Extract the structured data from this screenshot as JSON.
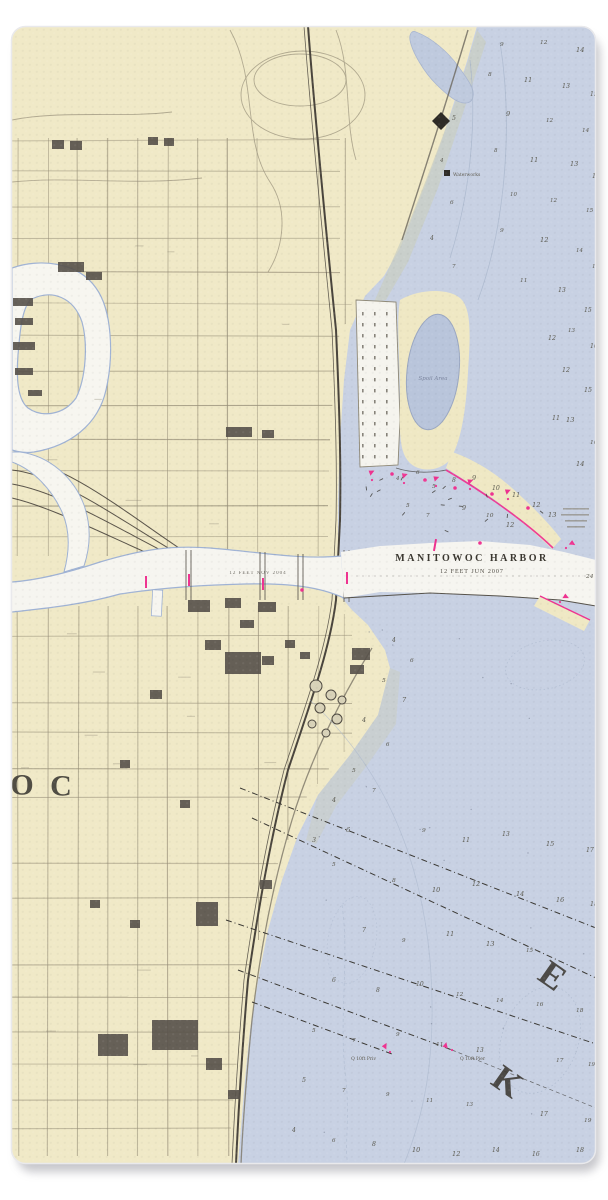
{
  "page": {
    "background": "#ffffff"
  },
  "towel": {
    "shadow_color": "rgba(130,130,138,0.5)",
    "base_land_color": "#f0e9c7",
    "water_color": "#c8d1e3"
  },
  "chart": {
    "title": "MANITOWOC HARBOR",
    "subtitle": "12 FEET JUN 2007",
    "channel_note": "12 FEET NOV 2004",
    "spoil_area_label": "Spoil Area",
    "waterworks_label": "Waterworks",
    "pier_label_left": "Q 10ft Priv",
    "pier_label_right": "Q 10ft Pier",
    "colors": {
      "land": "#f0e9c7",
      "water": "#c8d1e3",
      "pond": "#b9c5db",
      "channel_white": "#f6f5f0",
      "shoal": "#cacec3",
      "magenta": "#ee3390",
      "ink": "#3c3933",
      "rail": "#4a453d",
      "grid": "#948c76",
      "contour": "#a9b6cc"
    },
    "large_letters": [
      {
        "char": "O",
        "x": 22,
        "y": 784,
        "size": 30,
        "rot": 0
      },
      {
        "char": "C",
        "x": 61,
        "y": 785,
        "size": 30,
        "rot": 0
      },
      {
        "char": "E",
        "x": 553,
        "y": 975,
        "size": 36,
        "rot": 35
      },
      {
        "char": "K",
        "x": 508,
        "y": 1081,
        "size": 36,
        "rot": 35
      }
    ],
    "depth_soundings": [
      [
        500,
        46,
        "9"
      ],
      [
        540,
        44,
        "12"
      ],
      [
        576,
        52,
        "14"
      ],
      [
        488,
        76,
        "8"
      ],
      [
        524,
        82,
        "11"
      ],
      [
        562,
        88,
        "13"
      ],
      [
        590,
        96,
        "15"
      ],
      [
        506,
        116,
        "9"
      ],
      [
        546,
        122,
        "12"
      ],
      [
        582,
        132,
        "14"
      ],
      [
        494,
        152,
        "8"
      ],
      [
        530,
        162,
        "11"
      ],
      [
        570,
        166,
        "13"
      ],
      [
        592,
        178,
        "16"
      ],
      [
        510,
        196,
        "10"
      ],
      [
        550,
        202,
        "12"
      ],
      [
        586,
        212,
        "15"
      ],
      [
        500,
        232,
        "9"
      ],
      [
        540,
        242,
        "12"
      ],
      [
        576,
        252,
        "14"
      ],
      [
        592,
        268,
        "16"
      ],
      [
        520,
        282,
        "11"
      ],
      [
        558,
        292,
        "13"
      ],
      [
        452,
        120,
        "5"
      ],
      [
        440,
        162,
        "4"
      ],
      [
        450,
        204,
        "6"
      ],
      [
        430,
        240,
        "4"
      ],
      [
        452,
        268,
        "7"
      ],
      [
        584,
        312,
        "15"
      ],
      [
        568,
        332,
        "13"
      ],
      [
        590,
        348,
        "16"
      ],
      [
        562,
        372,
        "12"
      ],
      [
        584,
        392,
        "15"
      ],
      [
        566,
        422,
        "13"
      ],
      [
        590,
        444,
        "16"
      ],
      [
        576,
        466,
        "14"
      ],
      [
        548,
        340,
        "12"
      ],
      [
        552,
        420,
        "11"
      ],
      [
        396,
        480,
        "4"
      ],
      [
        416,
        474,
        "6"
      ],
      [
        432,
        488,
        "5"
      ],
      [
        452,
        482,
        "8"
      ],
      [
        472,
        480,
        "9"
      ],
      [
        492,
        490,
        "10"
      ],
      [
        512,
        497,
        "11"
      ],
      [
        532,
        507,
        "12"
      ],
      [
        548,
        517,
        "13"
      ],
      [
        406,
        507,
        "5"
      ],
      [
        426,
        517,
        "7"
      ],
      [
        462,
        510,
        "9"
      ],
      [
        486,
        517,
        "10"
      ],
      [
        506,
        527,
        "12"
      ],
      [
        586,
        578,
        "24"
      ],
      [
        392,
        642,
        "4"
      ],
      [
        410,
        662,
        "6"
      ],
      [
        382,
        682,
        "5"
      ],
      [
        402,
        702,
        "7"
      ],
      [
        362,
        722,
        "4"
      ],
      [
        386,
        746,
        "6"
      ],
      [
        352,
        772,
        "5"
      ],
      [
        372,
        792,
        "7"
      ],
      [
        332,
        802,
        "4"
      ],
      [
        346,
        832,
        "6"
      ],
      [
        312,
        842,
        "3"
      ],
      [
        332,
        866,
        "5"
      ],
      [
        422,
        832,
        "9"
      ],
      [
        462,
        842,
        "11"
      ],
      [
        502,
        836,
        "13"
      ],
      [
        546,
        846,
        "15"
      ],
      [
        586,
        852,
        "17"
      ],
      [
        392,
        882,
        "8"
      ],
      [
        432,
        892,
        "10"
      ],
      [
        472,
        886,
        "12"
      ],
      [
        516,
        896,
        "14"
      ],
      [
        556,
        902,
        "16"
      ],
      [
        590,
        906,
        "18"
      ],
      [
        362,
        932,
        "7"
      ],
      [
        402,
        942,
        "9"
      ],
      [
        446,
        936,
        "11"
      ],
      [
        486,
        946,
        "13"
      ],
      [
        526,
        952,
        "15"
      ],
      [
        332,
        982,
        "6"
      ],
      [
        376,
        992,
        "8"
      ],
      [
        416,
        986,
        "10"
      ],
      [
        456,
        996,
        "12"
      ],
      [
        496,
        1002,
        "14"
      ],
      [
        536,
        1006,
        "16"
      ],
      [
        576,
        1012,
        "18"
      ],
      [
        312,
        1032,
        "5"
      ],
      [
        352,
        1042,
        "7"
      ],
      [
        396,
        1036,
        "9"
      ],
      [
        436,
        1046,
        "11"
      ],
      [
        476,
        1052,
        "13"
      ],
      [
        556,
        1062,
        "17"
      ],
      [
        588,
        1066,
        "19"
      ],
      [
        302,
        1082,
        "5"
      ],
      [
        342,
        1092,
        "7"
      ],
      [
        386,
        1096,
        "9"
      ],
      [
        426,
        1102,
        "11"
      ],
      [
        466,
        1106,
        "13"
      ],
      [
        540,
        1116,
        "17"
      ],
      [
        584,
        1122,
        "19"
      ],
      [
        292,
        1132,
        "4"
      ],
      [
        332,
        1142,
        "6"
      ],
      [
        372,
        1146,
        "8"
      ],
      [
        412,
        1152,
        "10"
      ],
      [
        452,
        1156,
        "12"
      ],
      [
        492,
        1152,
        "14"
      ],
      [
        532,
        1156,
        "16"
      ],
      [
        576,
        1152,
        "18"
      ]
    ],
    "nav_markers": [
      {
        "x": 146,
        "y": 582,
        "t": "tick",
        "r": 0
      },
      {
        "x": 189,
        "y": 580,
        "t": "tick",
        "r": 0
      },
      {
        "x": 263,
        "y": 584,
        "t": "tick",
        "r": 0
      },
      {
        "x": 347,
        "y": 578,
        "t": "tick",
        "r": 0
      },
      {
        "x": 302,
        "y": 590,
        "t": "dot",
        "r": 0
      },
      {
        "x": 372,
        "y": 480,
        "t": "flag",
        "r": -20
      },
      {
        "x": 392,
        "y": 474,
        "t": "dot",
        "r": 0
      },
      {
        "x": 404,
        "y": 483,
        "t": "flag",
        "r": -12
      },
      {
        "x": 425,
        "y": 480,
        "t": "dot",
        "r": 0
      },
      {
        "x": 436,
        "y": 486,
        "t": "flag",
        "r": -15
      },
      {
        "x": 455,
        "y": 488,
        "t": "dot",
        "r": 0
      },
      {
        "x": 470,
        "y": 489,
        "t": "flag",
        "r": -15
      },
      {
        "x": 492,
        "y": 494,
        "t": "dot",
        "r": 0
      },
      {
        "x": 508,
        "y": 499,
        "t": "flag",
        "r": -18
      },
      {
        "x": 528,
        "y": 508,
        "t": "dot",
        "r": 0
      },
      {
        "x": 566,
        "y": 548,
        "t": "flag",
        "r": 38
      },
      {
        "x": 560,
        "y": 602,
        "t": "flag",
        "r": 32
      },
      {
        "x": 452,
        "y": 1050,
        "t": "flag",
        "r": -70
      },
      {
        "x": 390,
        "y": 1052,
        "t": "flag",
        "r": -55
      },
      {
        "x": 435,
        "y": 545,
        "t": "tick",
        "r": 10
      },
      {
        "x": 480,
        "y": 543,
        "t": "dot",
        "r": 0
      }
    ]
  }
}
